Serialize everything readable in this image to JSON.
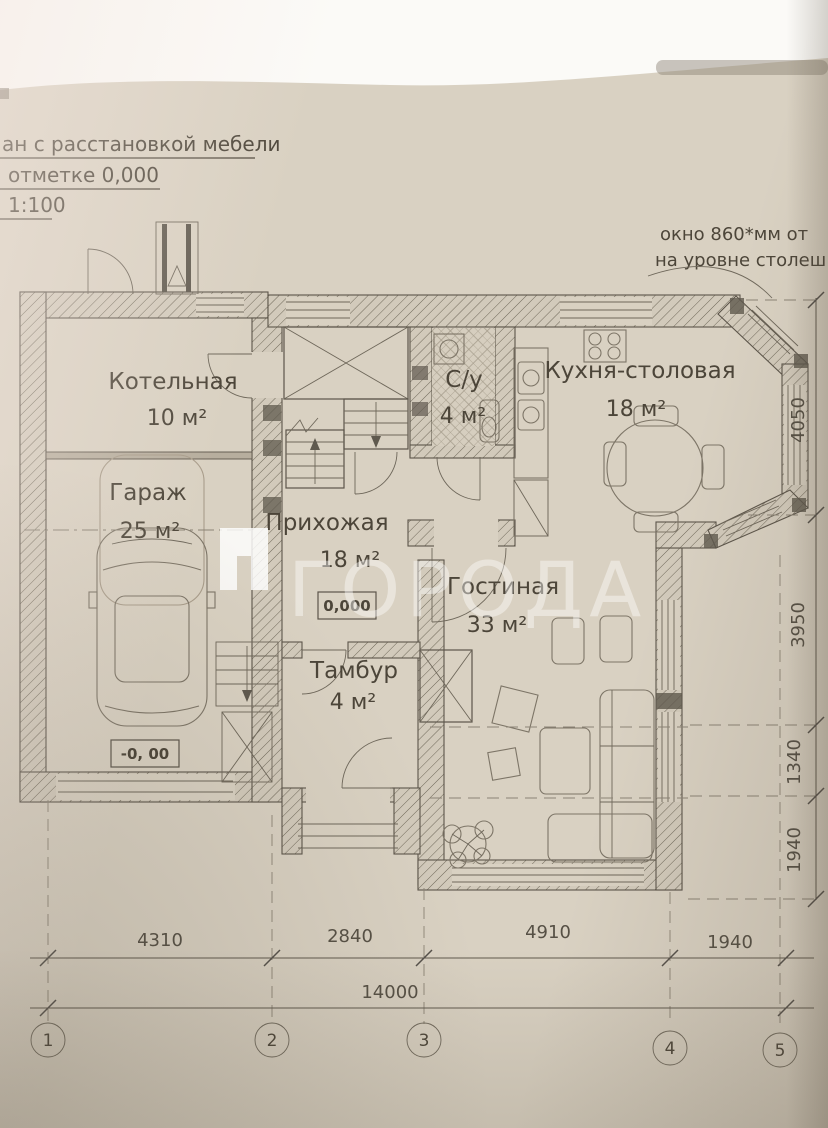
{
  "watermark": {
    "text": "ГОРОДА"
  },
  "title_block": {
    "line1": "ан с расстановкой мебели",
    "line2": "отметке 0,000",
    "line3": "1:100"
  },
  "window_note": {
    "line1": "окно 860*мм от",
    "line2": "на уровне столеш"
  },
  "rooms": [
    {
      "name": "Котельная",
      "area": "10 м²"
    },
    {
      "name": "Гараж",
      "area": "25 м²"
    },
    {
      "name": "С/у",
      "area": "4 м²"
    },
    {
      "name": "Кухня-столовая",
      "area": "18 м²"
    },
    {
      "name": "Прихожая",
      "area": "18 м²"
    },
    {
      "name": "Тамбур",
      "area": "4 м²"
    },
    {
      "name": "Гостиная",
      "area": "33 м²"
    }
  ],
  "elevation_marks": {
    "hall": "0,000",
    "garage": "-0, 00"
  },
  "dimensions": {
    "bottom_segments": [
      "4310",
      "2840",
      "4910",
      "1940"
    ],
    "bottom_total": "14000",
    "right_segments": [
      "4050",
      "3950",
      "1340",
      "1940"
    ]
  },
  "axes": [
    "1",
    "2",
    "3",
    "4",
    "5"
  ],
  "colors": {
    "paper": "#d9d1c2",
    "ink": "#5c554a"
  }
}
